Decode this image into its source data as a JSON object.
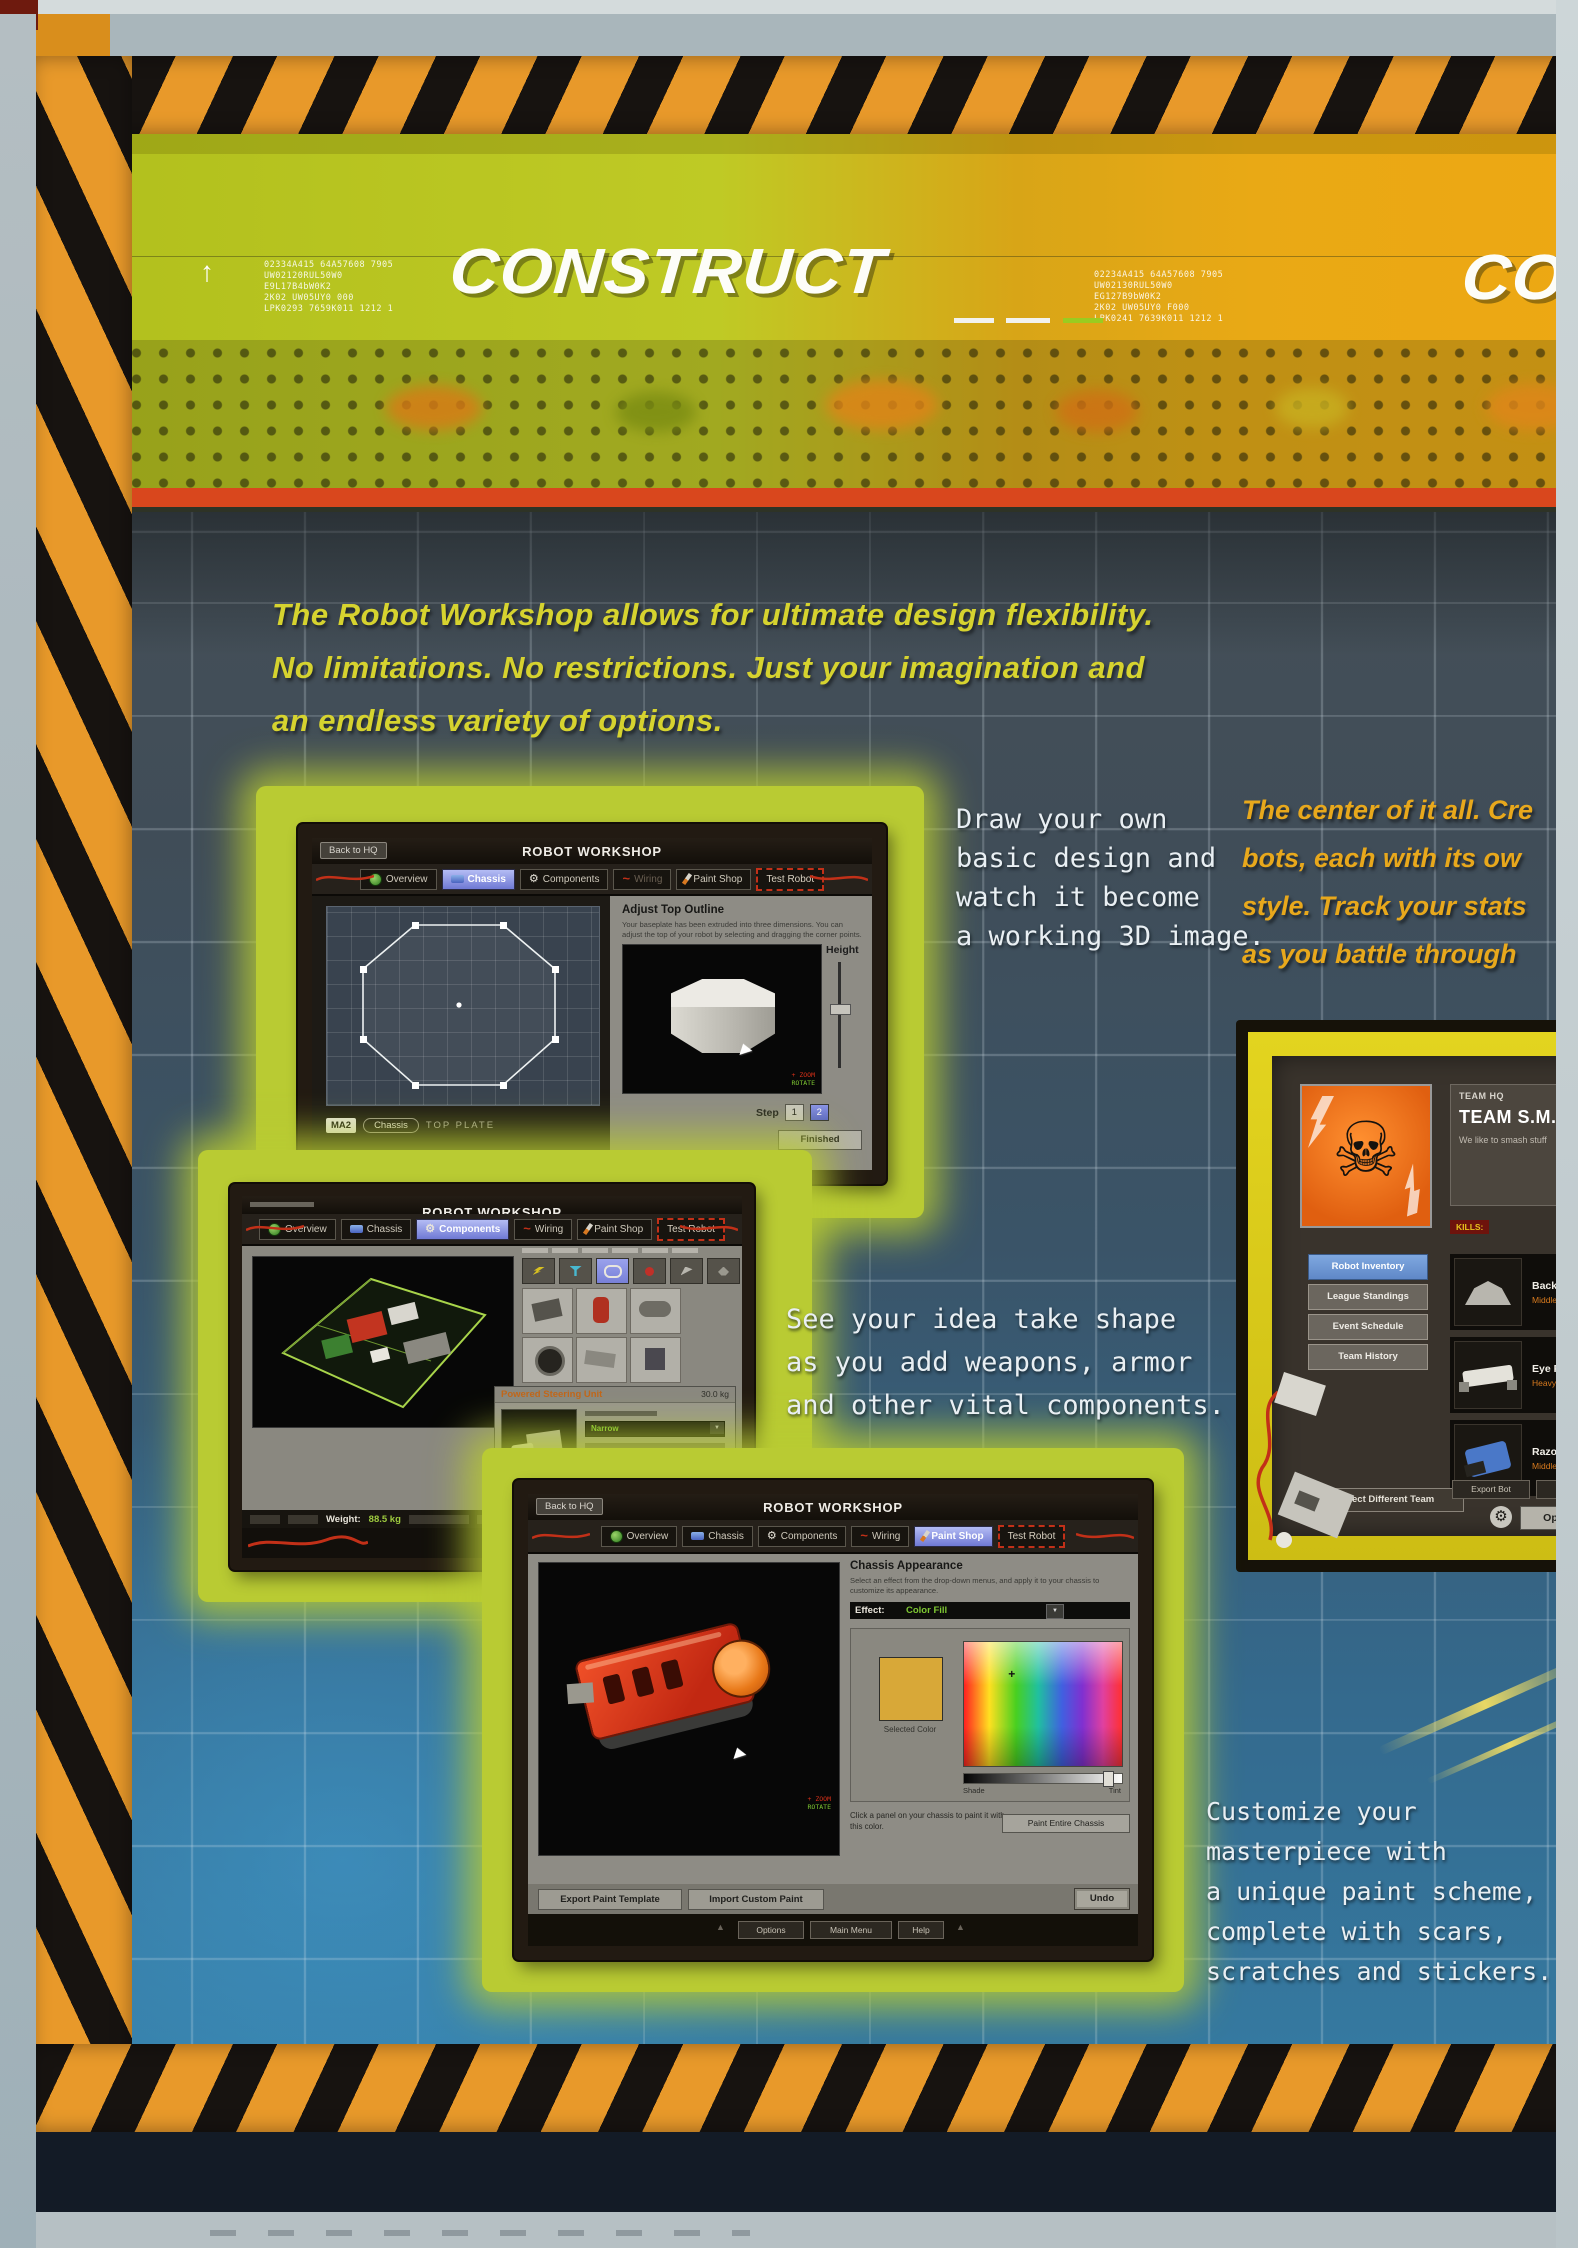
{
  "colors": {
    "hazard_orange": "#e8992a",
    "banner_green": "#b2c01d",
    "banner_orange": "#e9a915",
    "red_stripe": "#d9471d",
    "glow_green": "#b9cb33",
    "caption_white": "#e9eff3",
    "caption_yellow": "#d6d32f",
    "caption_orange": "#e8a81c",
    "tab_highlight": "#7e87d9",
    "selected_paint_color": "#d8a838"
  },
  "icons": {
    "gear": "⚙",
    "skull": "☠",
    "dropdown": "▼",
    "wave": "~",
    "plus": "+",
    "up_triangle": "▲"
  },
  "banner": {
    "title": "CONSTRUCT",
    "title_right_partial": "CONSTRUCT",
    "arrow": "↑",
    "code_left": [
      "02334A415 64A57608 7905",
      "UW02120RUL50W0",
      "E9L17B4bW0K2",
      "2K02 UW05UY0 000",
      "LPK0293 7659K011 1212 1"
    ],
    "code_right": [
      "02234A415 64A57608 7905",
      "UW02130RUL50W0",
      "EG127B9bW0K2",
      "2K02 UW05UY0 F000",
      "LPK0241 7639K011 1212 1"
    ]
  },
  "intro": {
    "line1": "The Robot Workshop allows for ultimate  design flexibility.",
    "line2": "No limitations. No restrictions. Just your imagination and",
    "line3": "an endless variety of options."
  },
  "captions": {
    "draw": [
      "Draw your own",
      "basic design and",
      "watch it become",
      "a working 3D image."
    ],
    "center": [
      "The center of it all. Cre",
      "bots, each with its ow",
      "style. Track  your stats",
      "as you battle through"
    ],
    "shape": [
      "See your idea take shape",
      "as you add weapons, armor",
      "and other vital components."
    ],
    "customize": [
      "Customize your",
      "masterpiece with",
      "a unique paint scheme,",
      "complete with scars,",
      "scratches and stickers."
    ]
  },
  "workshop": {
    "back_to_hq": "Back to HQ",
    "title": "ROBOT WORKSHOP",
    "tabs": [
      "Overview",
      "Chassis",
      "Components",
      "Wiring",
      "Paint Shop",
      "Test Robot"
    ]
  },
  "chassis_screen": {
    "panel_title": "Adjust Top Outline",
    "panel_desc1": "Your baseplate has been extruded into three dimensions. You can",
    "panel_desc2": "adjust the top of your robot by selecting and dragging the corner points.",
    "height_label": "Height",
    "zoom_hint": "+ ZOOM",
    "rotate_hint": "ROTATE",
    "step_label": "Step",
    "step_1": "1",
    "step_2": "2",
    "finished": "Finished",
    "badge": "MA2",
    "chassis_pill": "Chassis",
    "plate_label": "TOP PLATE"
  },
  "components_screen": {
    "detail_title": "Powered Steering Unit",
    "detail_weight": "30.0 kg",
    "dropdown_value": "Narrow",
    "weight_label": "Weight:",
    "weight_value": "88.5 kg",
    "options": "Options",
    "main_menu": "Main Menu"
  },
  "paint_screen": {
    "panel_title": "Chassis Appearance",
    "panel_desc1": "Select an effect from the drop-down menus, and apply it to your chassis to",
    "panel_desc2": "customize its appearance.",
    "effect_label": "Effect:",
    "effect_value": "Color Fill",
    "selected_color_label": "Selected Color",
    "shade_label": "Shade",
    "tint_label": "Tint",
    "click_text1": "Click a panel on your chassis to paint it with",
    "click_text2": "this color.",
    "paint_entire": "Paint Entire Chassis",
    "export_btn": "Export Paint Template",
    "import_btn": "Import Custom Paint",
    "undo_btn": "Undo",
    "options": "Options",
    "main_menu": "Main Menu",
    "help": "Help",
    "zoom_hint": "+ ZOOM",
    "rotate_hint": "ROTATE"
  },
  "team_hq": {
    "label": "TEAM HQ",
    "name": "TEAM S.M.A.S",
    "motto": "We like to smash stuff",
    "kills_label": "KILLS:",
    "menu": [
      "Robot Inventory",
      "League Standings",
      "Event Schedule",
      "Team History"
    ],
    "select_team": "Select Different Team",
    "robots": [
      {
        "name": "BackSlash",
        "class": "Middleweight"
      },
      {
        "name": "Eye Poker",
        "class": "Heavyweight"
      },
      {
        "name": "Razor",
        "class": "Middleweight"
      }
    ],
    "export_bot": "Export Bot",
    "import_bot": "Import Bot",
    "options": "Options"
  }
}
